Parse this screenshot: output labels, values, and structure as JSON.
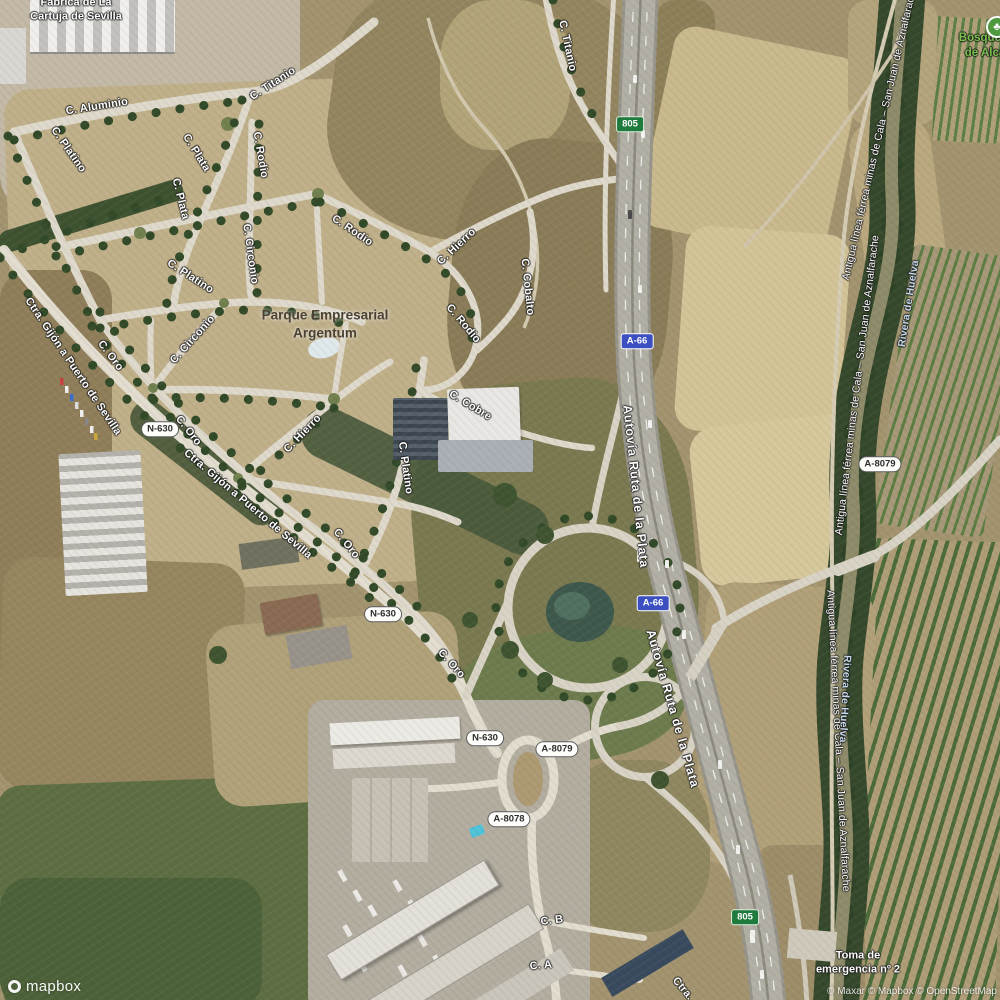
{
  "map": {
    "logo": "mapbox",
    "attribution": "© Maxar © Mapbox © OpenStreetMap",
    "colors": {
      "shield_blue": "#3b4fc0",
      "shield_green": "#1f7a3d",
      "label_green": "#7cc24e",
      "label_water": "#c6daeb",
      "poi_dark": "#4a4133"
    },
    "poi_labels": [
      {
        "text": "Fábrica de La\nCartuja de Sevilla",
        "x": 76,
        "y": 10,
        "style": "white"
      },
      {
        "text": "Parque Empresarial\nArgentum",
        "x": 325,
        "y": 324,
        "style": "dark"
      },
      {
        "text": "Bosquete\nde Alcá",
        "x": 985,
        "y": 46,
        "style": "green"
      },
      {
        "text": "Toma de\nemergencia nº 2",
        "x": 858,
        "y": 963,
        "style": "white"
      }
    ],
    "park_icon": {
      "name": "park-icon",
      "x": 997,
      "y": 27,
      "color": "#4e9a3c",
      "glyph": "♣"
    },
    "road_labels": [
      {
        "text": "C. Aluminio",
        "x": 97,
        "y": 107,
        "rot": -9
      },
      {
        "text": "C. Titanio",
        "x": 273,
        "y": 84,
        "rot": -33
      },
      {
        "text": "C. Titanio",
        "x": 567,
        "y": 46,
        "rot": 78
      },
      {
        "text": "C. Platino",
        "x": 68,
        "y": 150,
        "rot": 55
      },
      {
        "text": "C. Platino",
        "x": 190,
        "y": 277,
        "rot": 33
      },
      {
        "text": "C. Platino",
        "x": 405,
        "y": 468,
        "rot": 82
      },
      {
        "text": "C. Plata",
        "x": 196,
        "y": 153,
        "rot": 58
      },
      {
        "text": "C. Plata",
        "x": 180,
        "y": 199,
        "rot": 76
      },
      {
        "text": "C. Rodio",
        "x": 260,
        "y": 155,
        "rot": 80
      },
      {
        "text": "C. Rodio",
        "x": 352,
        "y": 231,
        "rot": 34
      },
      {
        "text": "C. Rodio",
        "x": 463,
        "y": 324,
        "rot": 50
      },
      {
        "text": "C. Circonio",
        "x": 250,
        "y": 254,
        "rot": 82
      },
      {
        "text": "C. Circonio",
        "x": 193,
        "y": 340,
        "rot": -48
      },
      {
        "text": "C. Hierro",
        "x": 457,
        "y": 247,
        "rot": -43
      },
      {
        "text": "C. Hierro",
        "x": 303,
        "y": 434,
        "rot": -46
      },
      {
        "text": "C. Cobalto",
        "x": 527,
        "y": 287,
        "rot": 84
      },
      {
        "text": "C. Cobre",
        "x": 470,
        "y": 406,
        "rot": 31
      },
      {
        "text": "C. Oro",
        "x": 110,
        "y": 356,
        "rot": 53
      },
      {
        "text": "C. Oro",
        "x": 188,
        "y": 431,
        "rot": 52
      },
      {
        "text": "C. Oro",
        "x": 346,
        "y": 544,
        "rot": 51
      },
      {
        "text": "C. Oro",
        "x": 451,
        "y": 664,
        "rot": 48
      },
      {
        "text": "C. B",
        "x": 552,
        "y": 921,
        "rot": -7
      },
      {
        "text": "C. A",
        "x": 541,
        "y": 966,
        "rot": -5
      },
      {
        "text": "Ctra. Gijón a Puerto de Sevilla",
        "x": 27,
        "y": 299,
        "rot": 56,
        "anchor": "start"
      },
      {
        "text": "Ctra. Gijón a Puerto de Sevilla",
        "x": 185,
        "y": 452,
        "rot": 40,
        "anchor": "start"
      },
      {
        "text": "Ctra.",
        "x": 674,
        "y": 979,
        "rot": 50,
        "anchor": "start"
      },
      {
        "text": "Autovía Ruta de la Plata",
        "x": 627,
        "y": 405,
        "rot": 84,
        "anchor": "start",
        "style": "hwy"
      },
      {
        "text": "Autovía Ruta de la Plata",
        "x": 650,
        "y": 630,
        "rot": 74,
        "anchor": "start",
        "style": "hwy"
      },
      {
        "text": "Antigua línea férrea minas de Cala – San Juan de Aznalfarache",
        "x": 846,
        "y": 280,
        "rot": -77,
        "anchor": "start",
        "style": "rail"
      },
      {
        "text": "Antigua línea férrea minas de Cala – San Juan de Aznalfarache",
        "x": 839,
        "y": 535,
        "rot": -83,
        "anchor": "start",
        "style": "rail"
      },
      {
        "text": "Antigua línea férrea minas de Cala – San Juan de Aznalfarache",
        "x": 830,
        "y": 590,
        "rot": 87,
        "anchor": "start",
        "style": "rail"
      },
      {
        "text": "Rivera de Huelva",
        "x": 902,
        "y": 347,
        "rot": -81,
        "anchor": "start",
        "style": "water"
      },
      {
        "text": "Rivera de Huelva",
        "x": 847,
        "y": 655,
        "rot": 93,
        "anchor": "start",
        "style": "water"
      }
    ],
    "shields": [
      {
        "text": "805",
        "style": "green",
        "x": 630,
        "y": 124
      },
      {
        "text": "805",
        "style": "green",
        "x": 745,
        "y": 917
      },
      {
        "text": "A-66",
        "style": "blue",
        "x": 637,
        "y": 341
      },
      {
        "text": "A-66",
        "style": "blue",
        "x": 653,
        "y": 603
      },
      {
        "text": "N-630",
        "style": "white",
        "x": 160,
        "y": 429
      },
      {
        "text": "N-630",
        "style": "white",
        "x": 383,
        "y": 614
      },
      {
        "text": "N-630",
        "style": "white",
        "x": 485,
        "y": 738
      },
      {
        "text": "A-8079",
        "style": "white",
        "x": 880,
        "y": 464
      },
      {
        "text": "A-8079",
        "style": "white",
        "x": 557,
        "y": 749
      },
      {
        "text": "A-8078",
        "style": "white",
        "x": 509,
        "y": 819
      }
    ]
  }
}
